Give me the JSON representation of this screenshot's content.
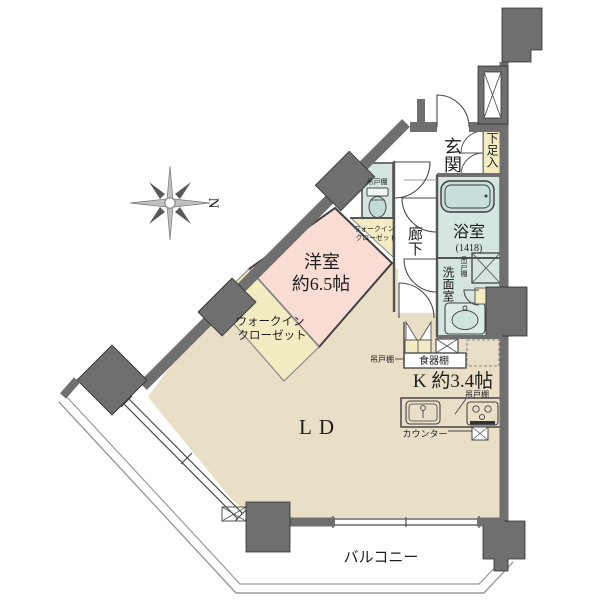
{
  "title": "マンション間取り図 1LDK",
  "compass": {
    "north_label": "N"
  },
  "labels": {
    "entrance": "玄関",
    "shoe_cabinet": "下足入",
    "bathroom": "浴室",
    "bathroom_size": "(1418)",
    "corridor": "廊下",
    "washroom": "洗面室",
    "hanging_cupboard": "吊戸棚",
    "western_room": "洋室",
    "western_room_size": "約6.5帖",
    "walk_in_closet_line1": "ウォークイン",
    "walk_in_closet_line2": "クローゼット",
    "living_dining": "LD",
    "kitchen": "K 約3.4帖",
    "cupboard": "食器棚",
    "counter": "カウンター",
    "balcony": "バルコニー"
  },
  "colors": {
    "wall": "#6f6f6f",
    "living_dining_kitchen": "#e9dfc7",
    "western_room": "#f9dcd3",
    "closet_yellow": "#f3ecc2",
    "wet_area_cyan": "#d5e6e1",
    "bathtub": "#c7dedb",
    "background": "#ffffff"
  }
}
